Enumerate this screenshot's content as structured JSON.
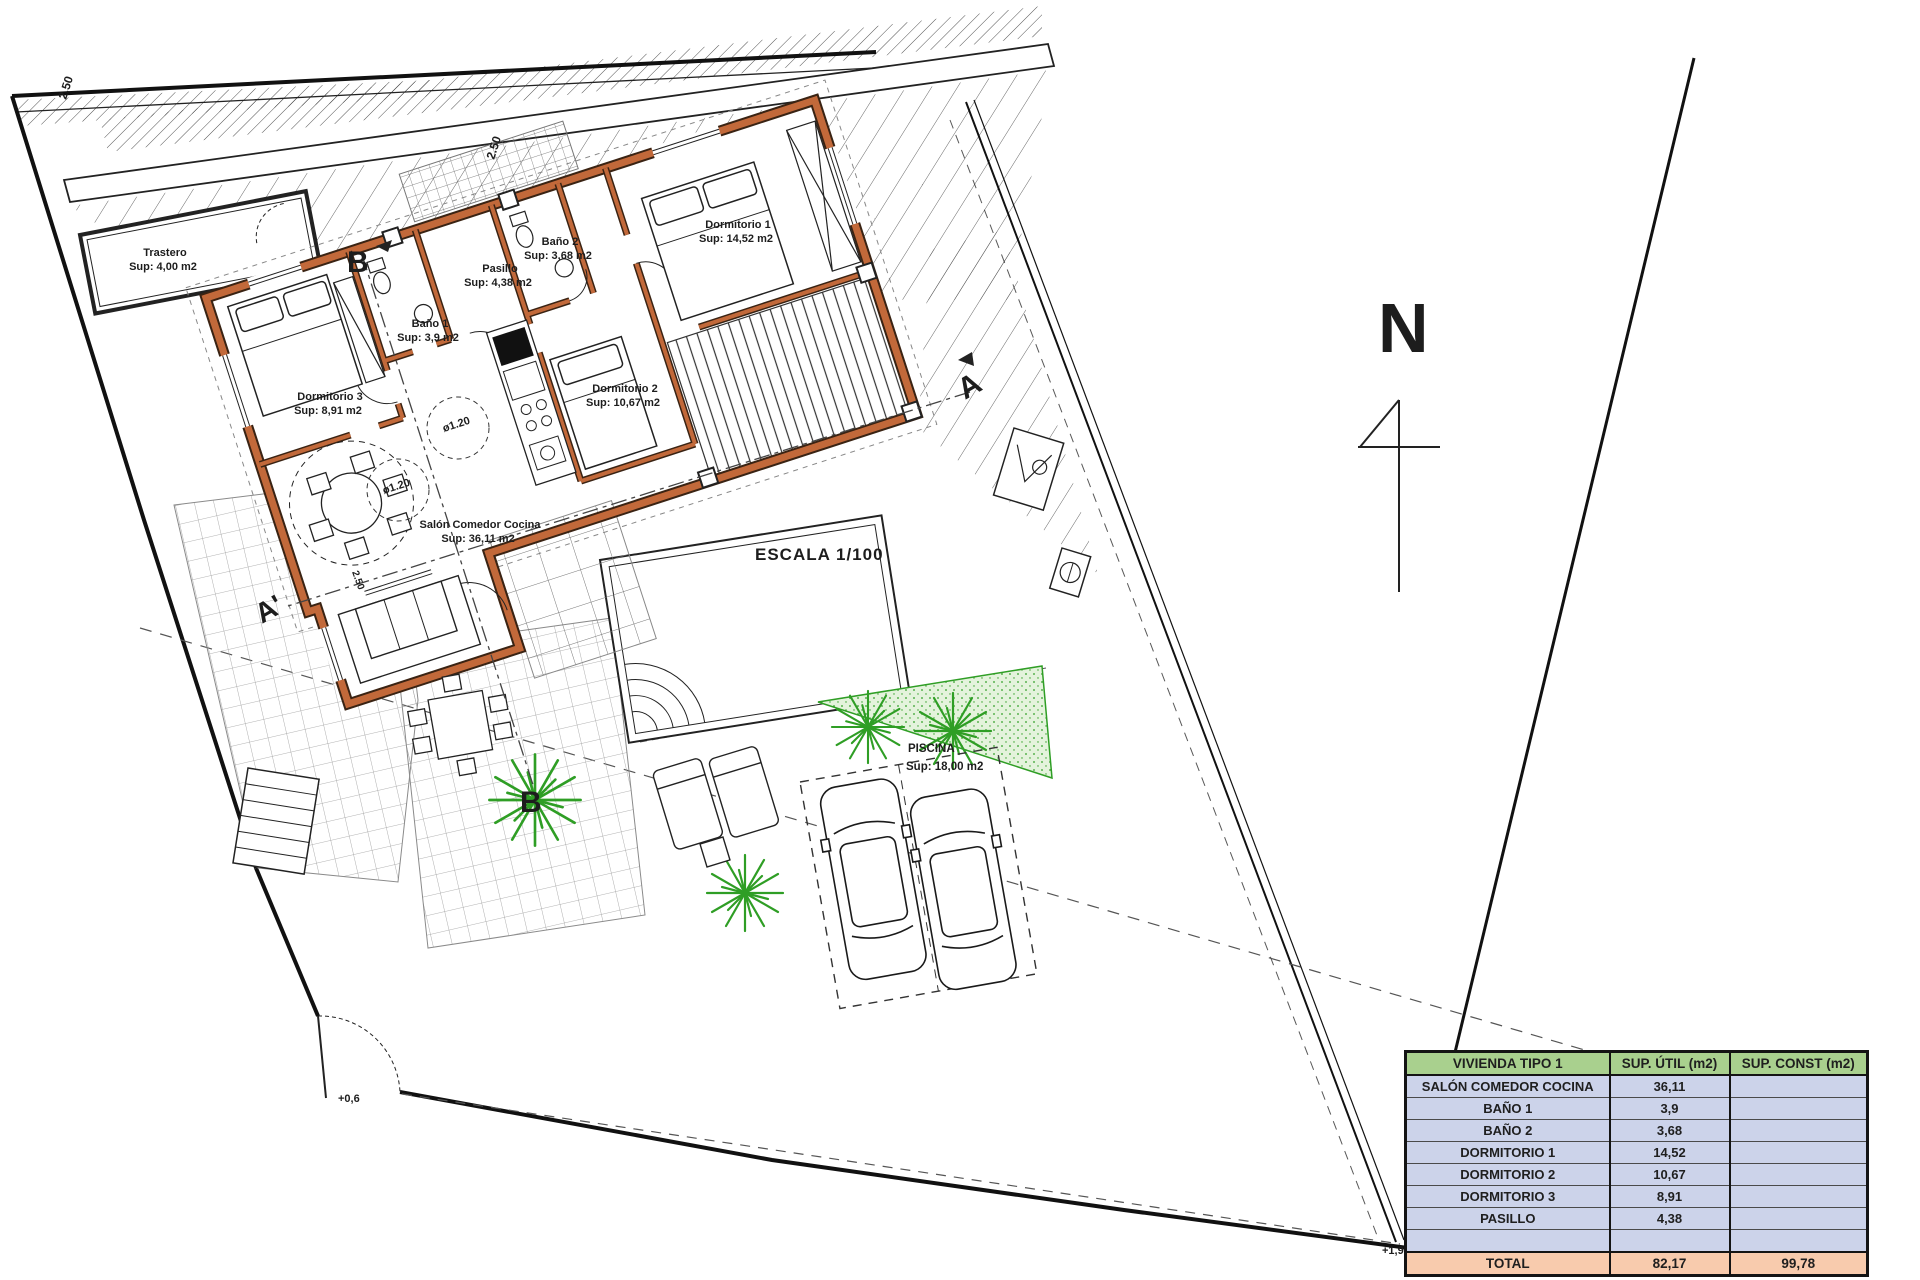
{
  "drawing": {
    "scale_label": "ESCALA 1/100",
    "north_label": "N",
    "rooms": {
      "trastero": {
        "name": "Trastero",
        "area": "Sup: 4,00 m2"
      },
      "pasillo": {
        "name": "Pasillo",
        "area": "Sup: 4,38 m2"
      },
      "bano1": {
        "name": "Baño 1",
        "area": "Sup: 3,9 m2"
      },
      "bano2": {
        "name": "Baño 2",
        "area": "Sup: 3,68 m2"
      },
      "dormitorio1": {
        "name": "Dormitorio 1",
        "area": "Sup: 14,52 m2"
      },
      "dormitorio2": {
        "name": "Dormitorio 2",
        "area": "Sup: 10,67 m2"
      },
      "dormitorio3": {
        "name": "Dormitorio 3",
        "area": "Sup: 8,91 m2"
      },
      "salon": {
        "name": "Salón Comedor Cocina",
        "area": "Sup: 36,11 m2"
      },
      "piscina": {
        "name": "PISCINA",
        "area": "Sup: 18,00 m2"
      }
    },
    "markers": {
      "section_b_top": "B",
      "section_b_bottom": "B",
      "section_a": "A",
      "section_a_prime": "A'",
      "dim_top_left": "2.50",
      "dim_right": "2.50",
      "dim_wing": "2.50",
      "diameter_1": "ø1.20",
      "diameter_2": "ø1.20",
      "level_entrance": "+0,6",
      "level_corner": "+1,9"
    },
    "colors": {
      "wall": "#c2693a",
      "wall_edge": "#3a2313",
      "vegetation": "#2f9e25",
      "boundary": "#111111"
    }
  },
  "table": {
    "headers": [
      "VIVIENDA TIPO 1",
      "SUP. ÚTIL (m2)",
      "SUP. CONST (m2)"
    ],
    "rows": [
      {
        "label": "SALÓN COMEDOR COCINA",
        "util": "36,11",
        "const": ""
      },
      {
        "label": "BAÑO 1",
        "util": "3,9",
        "const": ""
      },
      {
        "label": "BAÑO 2",
        "util": "3,68",
        "const": ""
      },
      {
        "label": "DORMITORIO 1",
        "util": "14,52",
        "const": ""
      },
      {
        "label": "DORMITORIO 2",
        "util": "10,67",
        "const": ""
      },
      {
        "label": "DORMITORIO 3",
        "util": "8,91",
        "const": ""
      },
      {
        "label": "PASILLO",
        "util": "4,38",
        "const": ""
      },
      {
        "label": "",
        "util": "",
        "const": ""
      }
    ],
    "total": {
      "label": "TOTAL",
      "util": "82,17",
      "const": "99,78"
    },
    "colors": {
      "header_bg": "#a9d08e",
      "row_bg": "#ccd3ea",
      "total_bg": "#f8cbad"
    }
  }
}
